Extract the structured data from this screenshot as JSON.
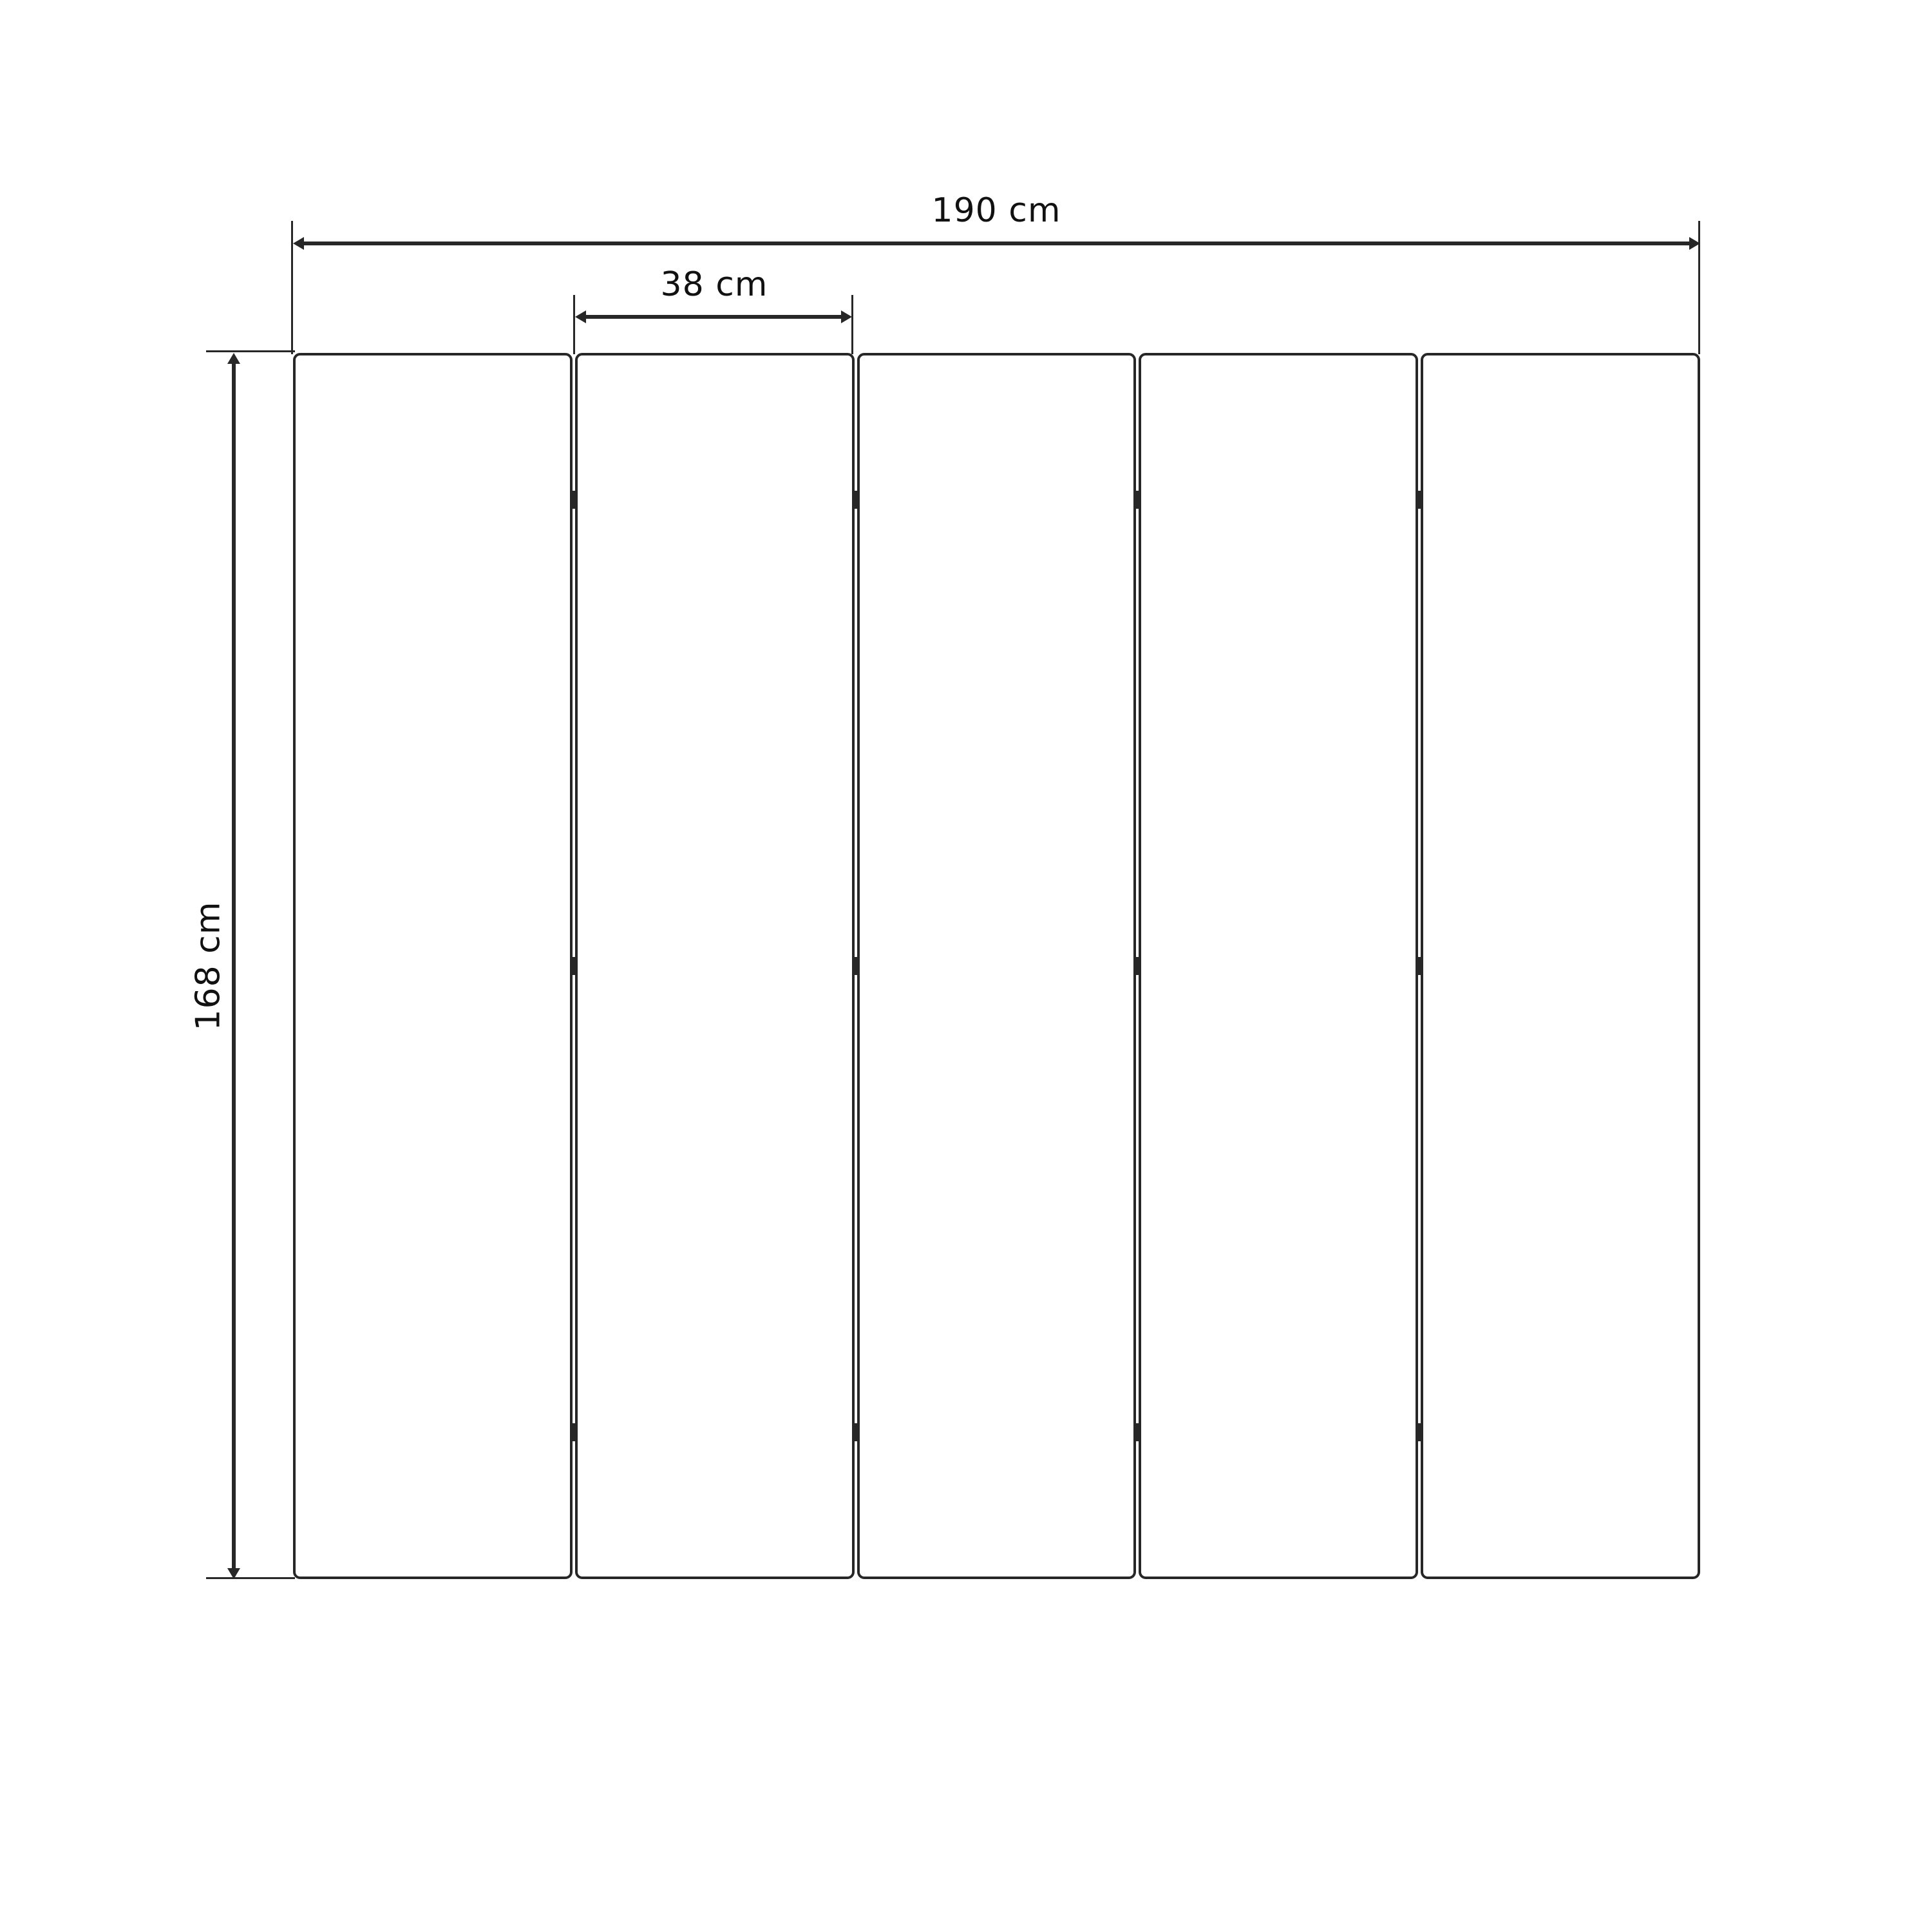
{
  "diagram": {
    "type": "furniture-dimension-drawing",
    "subject": "five-panel-folding-screen-front-view",
    "panel_count": 5,
    "hinge_rows_fraction": [
      0.12,
      0.5,
      0.88
    ],
    "hinges_per_gap": 3,
    "labels": {
      "total_width": "190 cm",
      "panel_width": "38 cm",
      "height": "168 cm"
    },
    "colors": {
      "ink": "#272727",
      "text": "#111111",
      "background": "#ffffff"
    }
  }
}
